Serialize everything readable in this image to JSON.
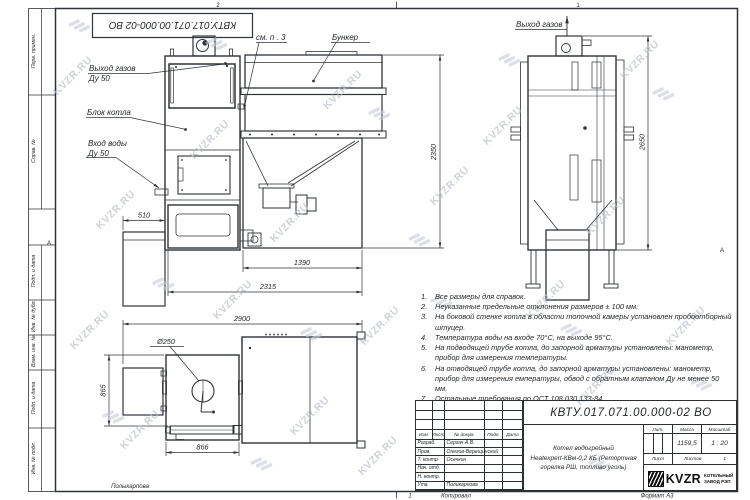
{
  "watermark": {
    "text": "KVZR.RU"
  },
  "stamp_top": "КВТУ.017.071.00.000-02 ВО",
  "frame": {
    "zones_top": [
      "2",
      "1"
    ],
    "zone_side": "А",
    "footer": {
      "zone": "1",
      "copied": "Копировал",
      "format": "Формат А3",
      "signature": "Полыкарпова"
    }
  },
  "margin_labels": [
    "Перв. примен.",
    "Справ. №",
    "Подп. и дата",
    "Инв. № дубл.",
    "Взам. инв. №",
    "Подп. и дата",
    "Инв. № подл."
  ],
  "drawing": {
    "callouts": {
      "gas_out_left": "Выход газов",
      "gas_out_left_size": "Ду 50",
      "boiler_block": "Блок котла",
      "water_in": "Вход воды",
      "water_in_size": "Ду 50",
      "see_note": "см. п . 3",
      "bunker": "Бункер",
      "gas_out_right": "Выход газов"
    },
    "dims": {
      "d510": "510",
      "d2350": "2350",
      "d1390": "1390",
      "d2315": "2315",
      "d2650": "2650",
      "d2900": "2900",
      "d250": "Ø250",
      "d865": "865",
      "d866": "866"
    }
  },
  "notes": [
    {
      "n": "1.",
      "t": "Все размеры для справок."
    },
    {
      "n": "2.",
      "t": "Неуказанные предельные отклонения размеров ± 100 мм."
    },
    {
      "n": "3.",
      "t": "На боковой стенке котла в области топочной камеры установлен пробоотборный штуцер."
    },
    {
      "n": "4.",
      "t": "Температура воды на входе 70°С, на выходе 95°С."
    },
    {
      "n": "5.",
      "t": "На подводящей трубе котла, до запорной арматуры установлены: манометр, прибор для измерения температуры."
    },
    {
      "n": "6.",
      "t": "На отводящей трубе котла, до запорной арматуры установлены: манометр, прибор для измерения емпературы, обвод с обратным клапаном Ду не менее 50 мм."
    },
    {
      "n": "7.",
      "t": "Остальные требования по ОСТ 108.030.133-84."
    }
  ],
  "title_block": {
    "doc_number": "КВТУ.017.071.00.000-02 ВО",
    "product_line1": "Котел водогрейный",
    "product_line2": "Heatexpert-КВм-0,2 КБ (Ретортная",
    "product_line3": "горелка РШ, топливо уголь)",
    "cols": {
      "izm": "Изм.",
      "list": "Лист",
      "doc": "№ докум.",
      "sign": "Подп.",
      "date": "Дата"
    },
    "rows": [
      {
        "role": "Разраб.",
        "name": "Сергач А.В."
      },
      {
        "role": "Пров.",
        "name": "Онегов-Верещинский"
      },
      {
        "role": "Т. контр.",
        "name": "Осечкин"
      },
      {
        "role": "Нач. отд.",
        "name": ""
      },
      {
        "role": "Н. контр.",
        "name": ""
      },
      {
        "role": "Утв.",
        "name": "Поликарпова"
      }
    ],
    "lit": "Лит.",
    "mass": "Масса",
    "scale": "Масштаб",
    "mass_value": "1159,5",
    "scale_value": "1 : 20",
    "sheet": "Лист",
    "sheets": "Листов",
    "sheets_value": "1",
    "logo": {
      "brand": "KVZR",
      "line1": "КОТЕЛЬНЫЙ",
      "line2": "ЗАВОД РЭП"
    }
  }
}
